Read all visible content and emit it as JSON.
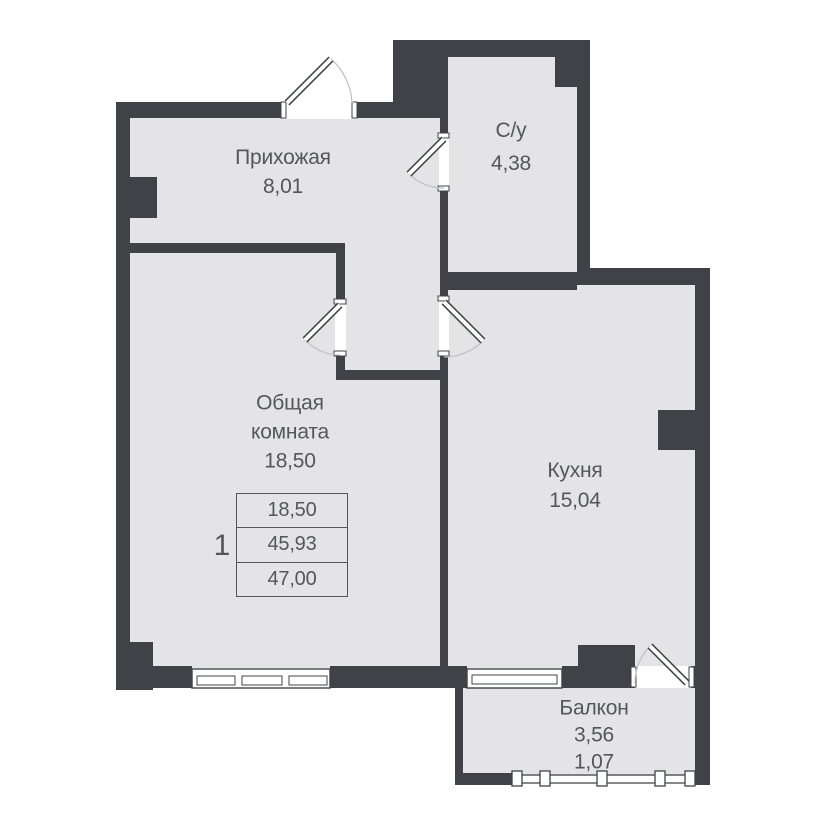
{
  "rooms": {
    "hallway": {
      "name": "Прихожая",
      "area": "8,01"
    },
    "bathroom": {
      "name": "С/у",
      "area": "4,38"
    },
    "living_room": {
      "name": "Общая комната",
      "area": "18,50"
    },
    "kitchen": {
      "name": "Кухня",
      "area": "15,04"
    },
    "balcony": {
      "name": "Балкон",
      "area": "3,56",
      "area_reduced": "1,07"
    }
  },
  "summary_table": {
    "rooms_count": "1",
    "living_area": "18,50",
    "area_without_balcony": "45,93",
    "total_area": "47,00"
  },
  "colors": {
    "wall": "#3f4347",
    "floor": "#e4e4e6",
    "text": "#54565a",
    "door_arc": "#c2c2c2"
  }
}
